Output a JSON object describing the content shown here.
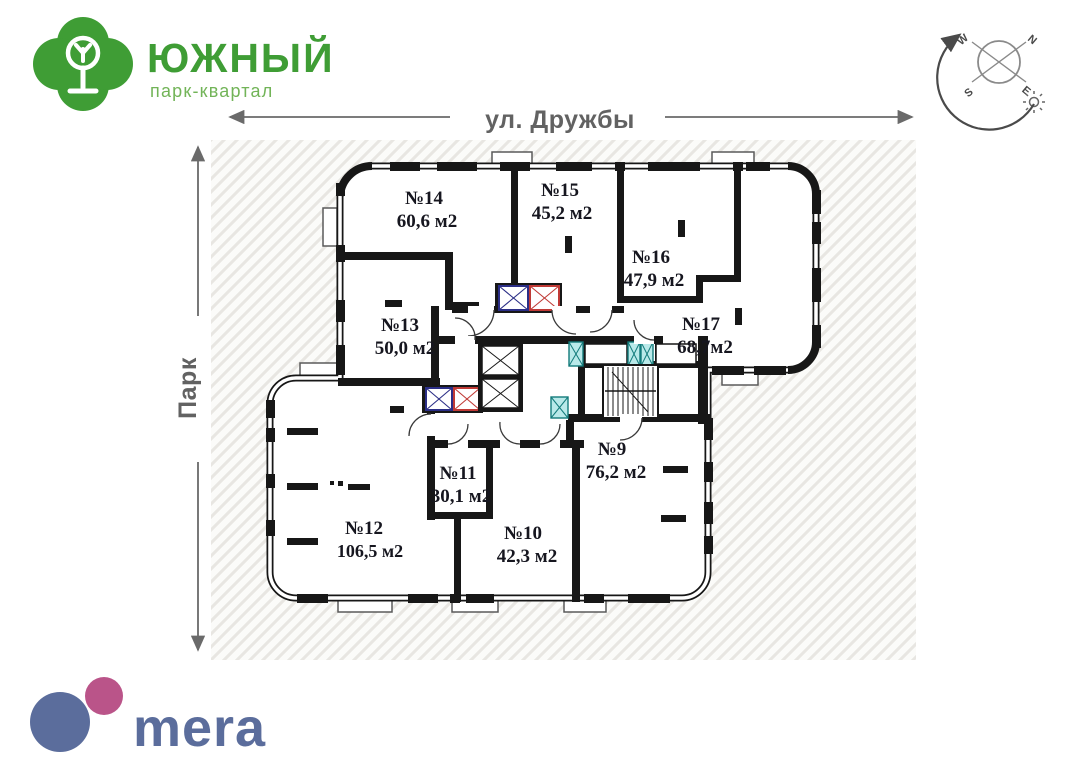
{
  "branding": {
    "project_name": "ЮЖНЫЙ",
    "project_tagline": "парк-квартал",
    "developer_name": "mera"
  },
  "orientation": {
    "street_label": "ул. Дружбы",
    "park_label": "Парк",
    "compass": {
      "north": "N",
      "south": "S",
      "west": "W",
      "east": "E"
    }
  },
  "plan": {
    "apartments": [
      {
        "number": "№14",
        "area": "60,6 м2"
      },
      {
        "number": "№15",
        "area": "45,2 м2"
      },
      {
        "number": "№16",
        "area": "47,9 м2"
      },
      {
        "number": "№17",
        "area": "68,7м2"
      },
      {
        "number": "№13",
        "area": "50,0 м2"
      },
      {
        "number": "№12",
        "area": "106,5 м2"
      },
      {
        "number": "№11",
        "area": "30,1 м2"
      },
      {
        "number": "№10",
        "area": "42,3 м2"
      },
      {
        "number": "№9",
        "area": "76,2 м2"
      }
    ]
  },
  "colors": {
    "brand_green": "#3f9d35",
    "brand_green_light": "#72b458",
    "mera_blue": "#5b6d9c",
    "mera_pink": "#b3417c",
    "elevator_blue": "#2b2e86",
    "elevator_red": "#c03a36",
    "shaft_cyan": "#b9e9e9",
    "wall_black": "#171717",
    "plan_text": "#16161f",
    "annotation_gray": "#626262"
  }
}
